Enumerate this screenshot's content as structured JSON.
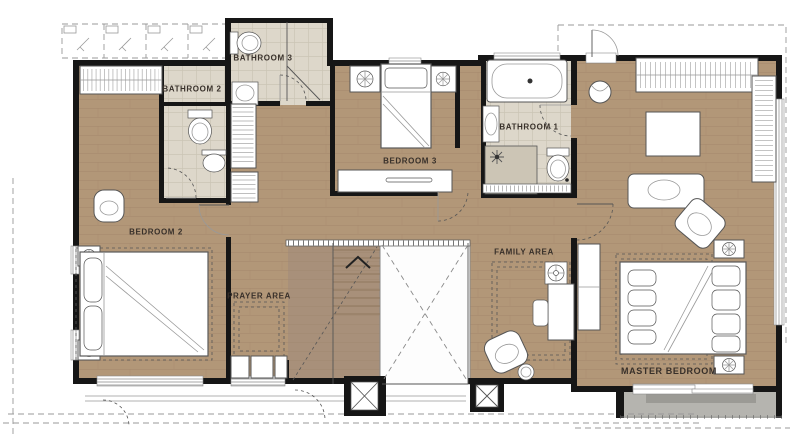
{
  "plan": {
    "type": "residential-upper-floor-plan",
    "rooms": [
      {
        "id": "bedroom-2",
        "label": "BEDROOM 2"
      },
      {
        "id": "bathroom-2",
        "label": "BATHROOM 2"
      },
      {
        "id": "bathroom-3",
        "label": "BATHROOM 3"
      },
      {
        "id": "bedroom-3",
        "label": "BEDROOM 3"
      },
      {
        "id": "bathroom-1",
        "label": "BATHROOM 1"
      },
      {
        "id": "family-area",
        "label": "FAMILY AREA"
      },
      {
        "id": "prayer-area",
        "label": "PRAYER AREA"
      },
      {
        "id": "master-bedroom",
        "label": "MASTER BEDROOM"
      }
    ]
  },
  "symbols": {
    "lamp": "circle-cross",
    "ceiling-fan": "circle-cross",
    "plant": "circle-asterisk",
    "stair-direction": "chevron-up",
    "void": "crossed-dashed-diagonals",
    "column": "boxed-x",
    "shower-head": "star-burst"
  },
  "colors": {
    "paper": "#ffffff",
    "wood": "#b29778",
    "wood-line": "#9d8165",
    "stair": "#a8907a",
    "stair-line": "#8f775f",
    "tile": "#ddd7ca",
    "tile-line": "#c6bfae",
    "shower": "#ccc5b5",
    "wall": "#161616",
    "line": "#555555",
    "line-light": "#999999",
    "balcony": "#b5b4af",
    "balcony-dark": "#9b9a95",
    "label": "#38302a"
  }
}
